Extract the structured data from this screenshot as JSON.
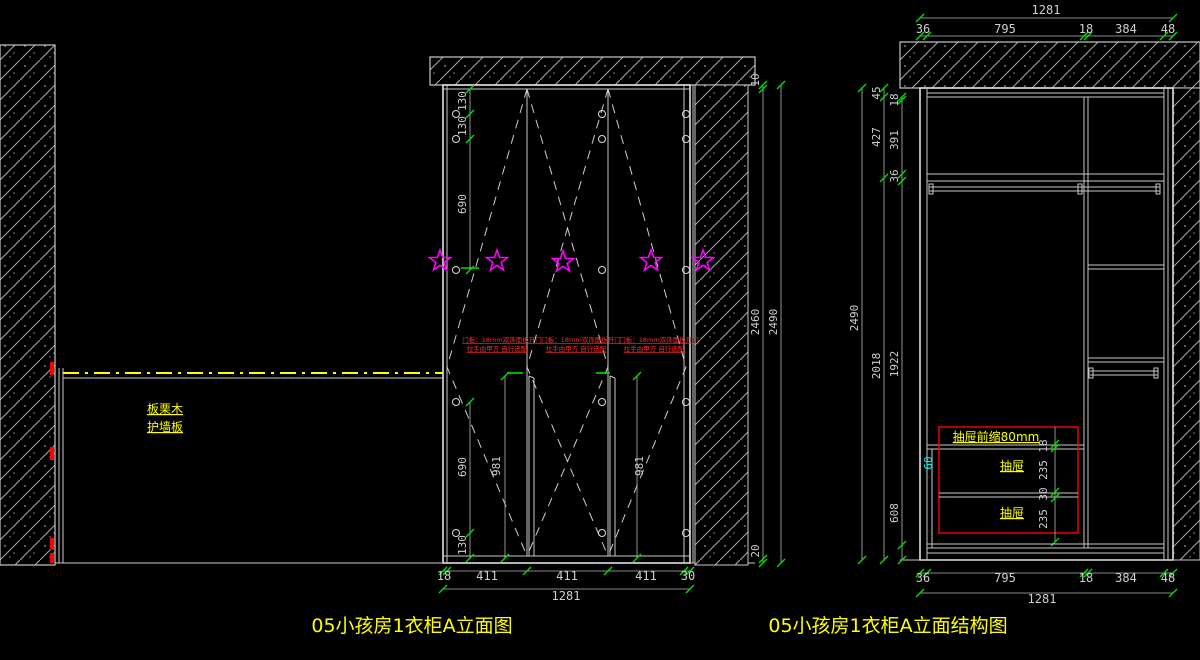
{
  "titles": {
    "elevation": "05小孩房1衣柜A立面图",
    "structure": "05小孩房1衣柜A立面结构图"
  },
  "wall_panel": {
    "line1": "板栗木",
    "line2": "护墙板"
  },
  "elevation": {
    "door_note": {
      "line1": "门板：18mm双饰面板开门",
      "line2": "拉手由甲方 自行选配"
    },
    "dims": {
      "v130a": "130",
      "v130b": "130",
      "v690top": "690",
      "v690bot": "690",
      "v130bot": "130",
      "handle_left": "981",
      "handle_right": "981",
      "bottom": [
        "18",
        "411",
        "411",
        "411",
        "30"
      ],
      "bottom_total": "1281",
      "r10": "10",
      "r2460": "2460",
      "r20": "20",
      "r2490": "2490"
    }
  },
  "structure": {
    "drawer_note": "抽屉前缩80mm",
    "drawer1": "抽屉",
    "drawer2": "抽屉",
    "dims": {
      "top_total": "1281",
      "top": [
        "36",
        "795",
        "18",
        "384",
        "48"
      ],
      "bottom": [
        "36",
        "795",
        "18",
        "384",
        "48"
      ],
      "bottom_total": "1281",
      "l2490": "2490",
      "l45": "45",
      "l427": "427",
      "l2018": "2018",
      "l18": "18",
      "l391": "391",
      "l36": "36",
      "l1922": "1922",
      "l608": "608",
      "d18": "18",
      "d235a": "235",
      "d30": "30",
      "d235b": "235",
      "d60": "60"
    }
  },
  "colors": {
    "background": "#000000",
    "line": "#c8c8c8",
    "dimension_text": "#cfcfcf",
    "tick_green": "#00dd00",
    "annotation_yellow": "#ffff00",
    "annotation_red": "#ff2a2a",
    "star_magenta": "#ff00ff",
    "cyan_dim": "#00ffff"
  }
}
